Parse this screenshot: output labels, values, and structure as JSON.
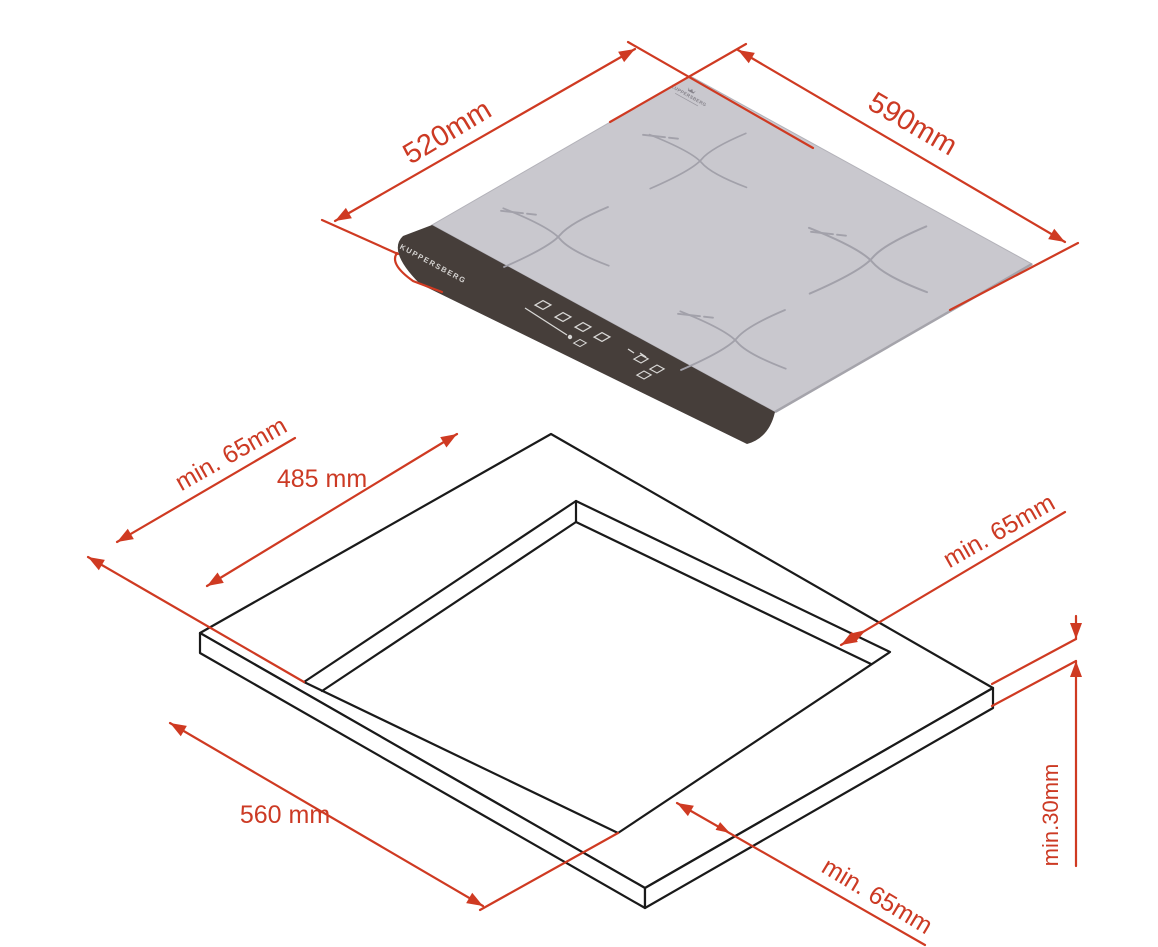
{
  "document": {
    "kind": "appliance installation drawing",
    "background": "#ffffff"
  },
  "cooktop_view": {
    "name": "induction hob overall dimensions (isometric)",
    "logo_label": "KUPPERSBERG",
    "brand_panel_label": "KUPPERSBERG",
    "dim_depth": "520mm",
    "dim_width": "590mm"
  },
  "cutout_view": {
    "name": "worktop cut-out dimensions (isometric)",
    "dim_clearance_left": "min. 65mm",
    "dim_cutout_depth": "485 mm",
    "dim_clearance_right": "min. 65mm",
    "dim_cutout_width": "560 mm",
    "dim_clearance_front": "min. 65mm",
    "dim_worktop_thickness": "min.30mm"
  },
  "colors": {
    "dimension_red": "#cf3a22",
    "outline_black": "#1a1a1a",
    "glass_gray": "#c9c8ce",
    "panel_dark": "#463e3a",
    "zone_mark_gray": "#a2a1aa"
  }
}
